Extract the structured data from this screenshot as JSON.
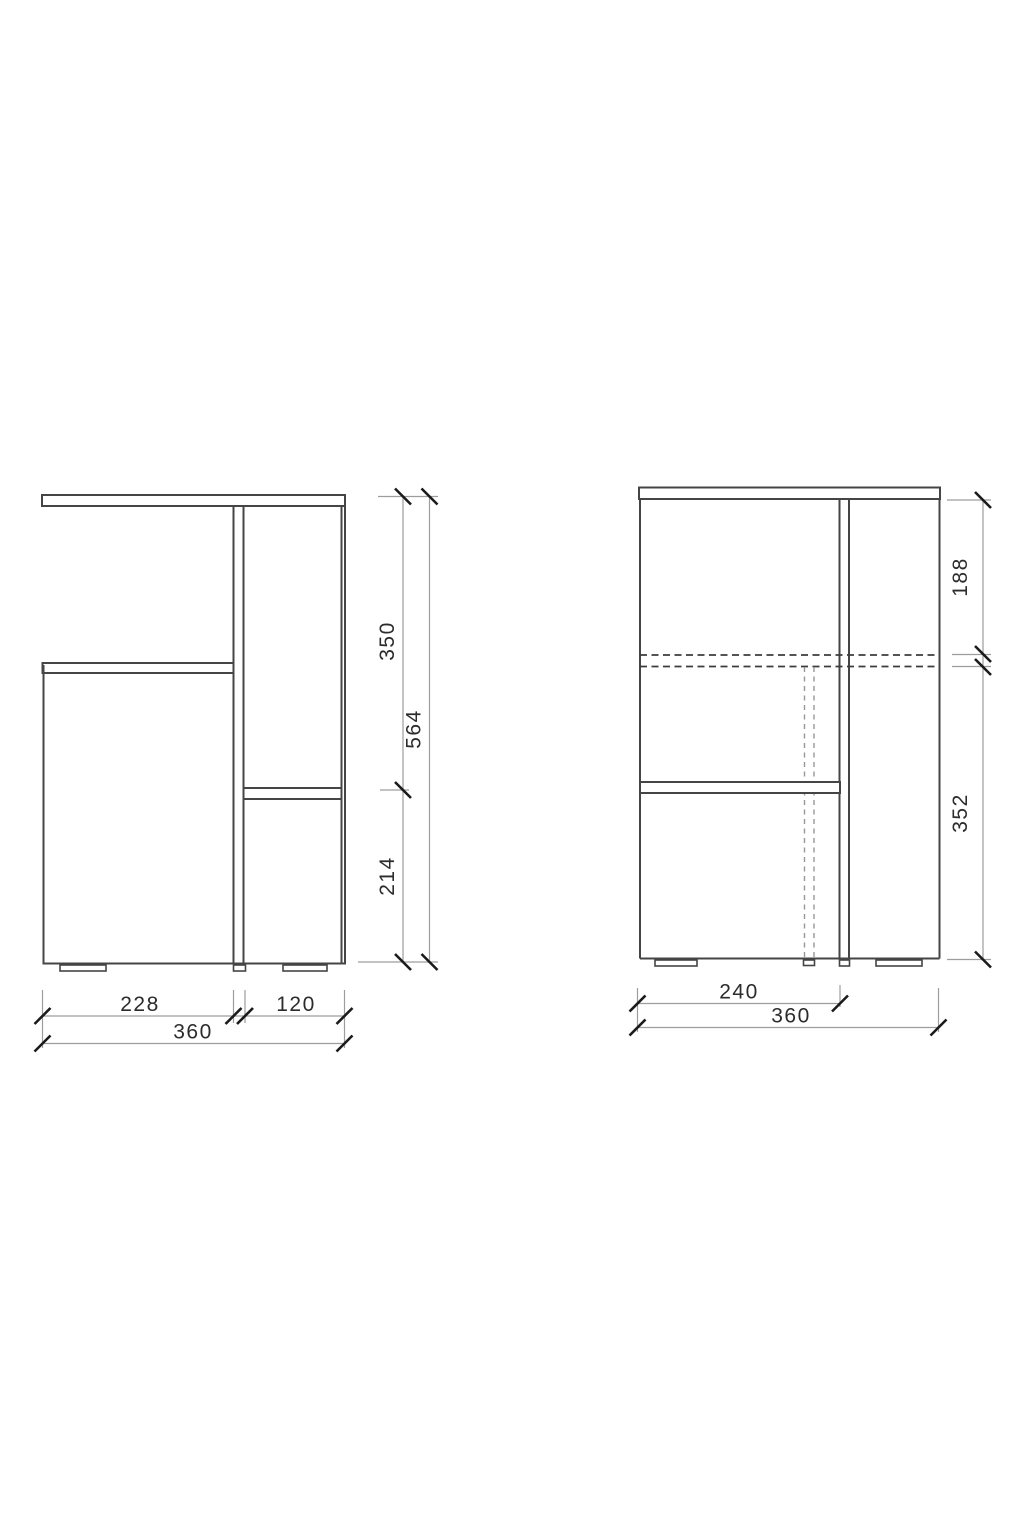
{
  "drawing": {
    "kind": "furniture-technical-drawing",
    "views": {
      "front": {
        "name": "front view",
        "dims": {
          "height_upper": "350",
          "height_total": "564",
          "height_lower": "214",
          "width_left": "228",
          "width_right": "120",
          "width_total": "360"
        }
      },
      "side": {
        "name": "side view",
        "dims": {
          "height_upper": "188",
          "height_lower": "352",
          "depth_shelf": "240",
          "depth_total": "360"
        }
      }
    },
    "colors": {
      "background": "#ffffff",
      "outline": "#454545",
      "dimension_line": "#9d9d9d",
      "tick": "#1b1b1b",
      "label": "#2c2c2c",
      "hidden_line_dark": "#3c3c3c",
      "hidden_line_light": "#979797"
    }
  }
}
